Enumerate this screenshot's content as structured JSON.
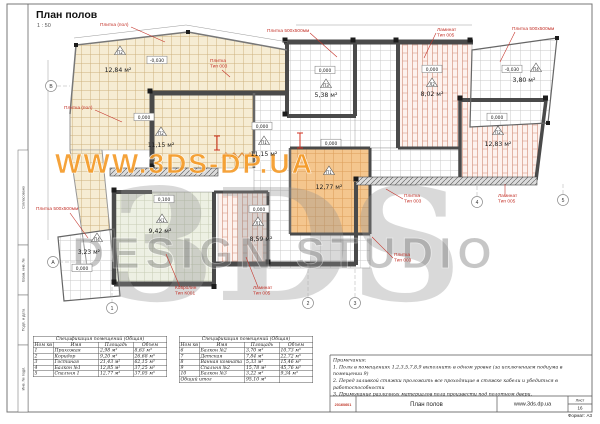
{
  "page": {
    "title": "План полов",
    "scale": "1 : 50"
  },
  "watermark": {
    "url": "WWW.3DS-DP.UA",
    "logo": "3DS",
    "studio": "DESIGN STUDIO"
  },
  "colors": {
    "label_red": "#c4332a",
    "tile_beige": "#f6ecd3",
    "tile_orange": "#f4c68e",
    "laminate": "#d18b75",
    "watermark_orange": "#f59a26"
  },
  "rooms": [
    {
      "id": "terrace",
      "area": "12,84 м²",
      "marker": "П2",
      "elevation": "-0,030"
    },
    {
      "id": "hallway",
      "area": "5,38 м²",
      "marker": "П3",
      "elevation": "0,000"
    },
    {
      "id": "room-laminate-top",
      "area": "8,02 м²",
      "marker": "Л2",
      "elevation": "0,000"
    },
    {
      "id": "balcony-right",
      "area": "3,80 м²",
      "marker": "П4",
      "elevation": "-0,030"
    },
    {
      "id": "room-tile-left",
      "area": "11,15 м²",
      "marker": "П2",
      "elevation": "0,000"
    },
    {
      "id": "room-tile-center",
      "area": "11,15 м²",
      "marker": "П1",
      "elevation": "0,000"
    },
    {
      "id": "bedroom-1",
      "area": "12,77 м²",
      "marker": "П1",
      "elevation": "0,000"
    },
    {
      "id": "bedroom-2",
      "area": "12,83 м²",
      "marker": "П2",
      "elevation": "0,000"
    },
    {
      "id": "balcony-left",
      "area": "3,23 м²",
      "marker": "П4",
      "elevation": "0,000"
    },
    {
      "id": "carpet-room",
      "area": "9,42 м²",
      "marker": "К1",
      "elevation": "0,100"
    },
    {
      "id": "room-laminate-bottom",
      "area": "8,59 м²",
      "marker": "Л1",
      "elevation": "0,000"
    }
  ],
  "material_labels": [
    {
      "line1": "Плитка (пол)",
      "line2": ""
    },
    {
      "line1": "Плитка 500х500мм",
      "line2": ""
    },
    {
      "line1": "Ламинат",
      "line2": "Тип 005"
    },
    {
      "line1": "Плитка 500х500мм",
      "line2": ""
    },
    {
      "line1": "Плитка",
      "line2": "Тип 003"
    },
    {
      "line1": "Плитка (пол)",
      "line2": ""
    },
    {
      "line1": "Плитка 500х500мм",
      "line2": ""
    },
    {
      "line1": "Ковролин",
      "line2": "Тип К001"
    },
    {
      "line1": "Ламинат",
      "line2": "Тип 005"
    },
    {
      "line1": "Плитка",
      "line2": "Тип 003"
    },
    {
      "line1": "Плитка",
      "line2": "Тип 003"
    },
    {
      "line1": "Ламинат",
      "line2": "Тип 005"
    }
  ],
  "axes": {
    "bottom": [
      "1",
      "2",
      "3",
      "4",
      "5"
    ],
    "left": [
      "В",
      "А"
    ]
  },
  "tables": {
    "left": {
      "title": "Спецификация помещений (Общая)",
      "col_num": "Ном кв",
      "col_name": "Имя",
      "col_area": "Площадь",
      "col_volume": "Объем",
      "rows": [
        {
          "n": "1",
          "name": "Прихожая",
          "area": "2,98 м²",
          "volume": "8,63 м³"
        },
        {
          "n": "2",
          "name": "Коридор",
          "area": "9,20 м²",
          "volume": "26,68 м³"
        },
        {
          "n": "3",
          "name": "Гостиная",
          "area": "21,43 м²",
          "volume": "62,15 м³"
        },
        {
          "n": "4",
          "name": "Балкон №1",
          "area": "12,85 м²",
          "volume": "37,25 м³"
        },
        {
          "n": "5",
          "name": "Спальня 1",
          "area": "12,77 м²",
          "volume": "37,05 м³"
        }
      ]
    },
    "right": {
      "title": "Спецификация помещений (Общая)",
      "col_num": "Ном кв",
      "col_name": "Имя",
      "col_area": "Площадь",
      "col_volume": "Объем",
      "rows": [
        {
          "n": "6",
          "name": "Балкон №2",
          "area": "3,70 м²",
          "volume": "10,73 м³"
        },
        {
          "n": "7",
          "name": "Детская",
          "area": "7,84 м²",
          "volume": "22,72 м³"
        },
        {
          "n": "8",
          "name": "Ванная комната",
          "area": "5,33 м²",
          "volume": "15,46 м³"
        },
        {
          "n": "9",
          "name": "Спальня №2",
          "area": "15,78 м²",
          "volume": "45,76 м³"
        },
        {
          "n": "10",
          "name": "Балкон №3",
          "area": "3,22 м²",
          "volume": "9,34 м³"
        }
      ],
      "total_label": "Общий итог",
      "total_area": "95,10 м²"
    }
  },
  "notes": {
    "heading": "Примечания:",
    "items": [
      "1. Полы в помещениях 1,2,3,5,7,8,9 выполнить в одном уровне (за исключением подиума в помещении 9)",
      "2. Перед заливкой стяжки проложить все проходящие в стяжке кабели и убедиться в работоспособности",
      "3. Примыкание различных материалов пола произвести под полотном двери."
    ]
  },
  "titleblock": {
    "stamp": "20160601",
    "doc_title": "План полов",
    "website": "www.3ds.dp.ua",
    "sheet_label": "Лист",
    "sheet_number": "16",
    "format": "Формат: А3"
  },
  "stamp_column": {
    "labels": [
      "Согласовано",
      "Взам. инв. №",
      "Подп. и дата",
      "Инв. № подл."
    ]
  }
}
